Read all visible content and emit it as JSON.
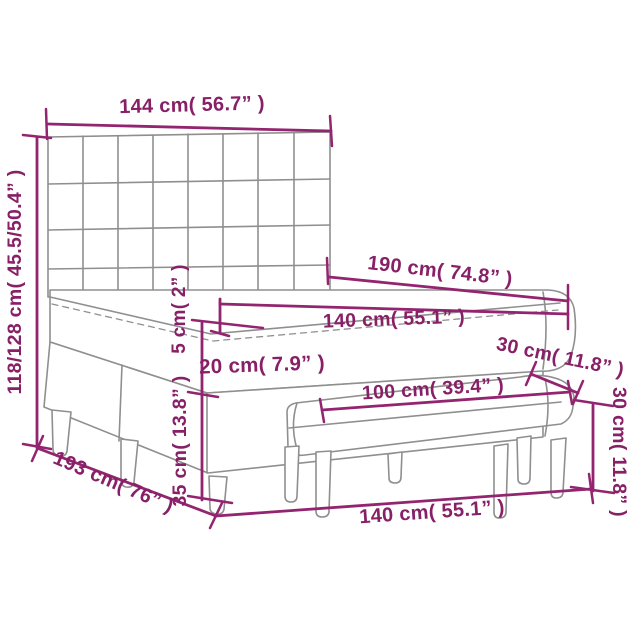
{
  "diagram": {
    "type": "product-dimension-diagram",
    "subject": "box spring bed with tufted headboard and bench",
    "colors": {
      "dimension_line": "#93246f",
      "dimension_text": "#872066",
      "drawing_line": "#8f8f8f",
      "background": "#ffffff"
    },
    "dimensions": {
      "headboard_width": {
        "label": "144 cm( 56.7” )"
      },
      "total_height": {
        "label": "118/128 cm( 45.5/50.4” )"
      },
      "bed_length": {
        "label": "190 cm( 74.8” )"
      },
      "mattress_width": {
        "label": "140 cm( 55.1” )"
      },
      "topper_thickness": {
        "label": "5 cm( 2” )"
      },
      "mattress_thickness": {
        "label": "20 cm( 7.9” )"
      },
      "base_height": {
        "label": "35 cm( 13.8” )"
      },
      "bed_depth": {
        "label": "193 cm( 76” )"
      },
      "bench_depth": {
        "label": "30 cm( 11.8” )"
      },
      "bench_length": {
        "label": "100 cm( 39.4” )"
      },
      "bench_height": {
        "label": "30 cm( 11.8” )"
      },
      "base_width": {
        "label": "140 cm( 55.1” )"
      }
    }
  }
}
